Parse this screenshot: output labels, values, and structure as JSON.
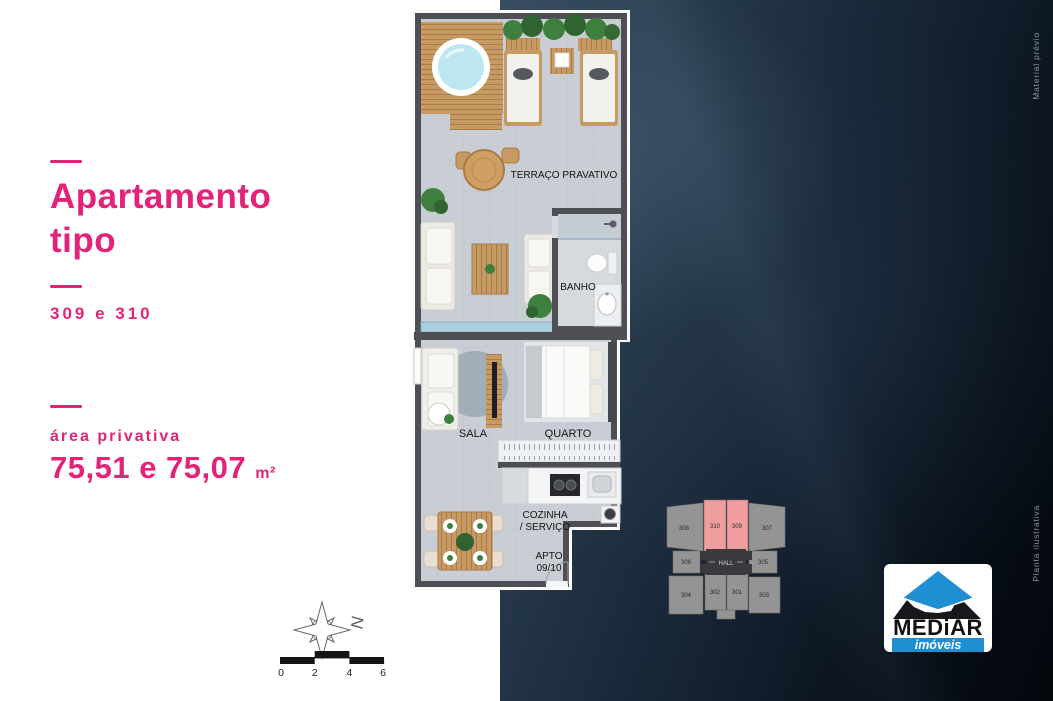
{
  "colors": {
    "accent": "#e32278",
    "dark_panel": "#0a1420",
    "keyplan_highlight": "#ef9e9d",
    "keyplan_gray": "#949494",
    "logo_blue": "#1e8fd2"
  },
  "info_panel": {
    "title_line1": "Apartamento",
    "title_line2": "tipo",
    "unit_numbers": "309 e 310",
    "area_label": "área privativa",
    "area_value": "75,51 e 75,07",
    "area_unit": "m²"
  },
  "floorplan": {
    "rooms": {
      "terrace": "TERRAÇO PRAVATIVO",
      "bathroom": "BANHO",
      "living": "SALA",
      "bedroom": "QUARTO",
      "kitchen_line1": "COZINHA",
      "kitchen_line2": "/ SERVIÇO",
      "unit_line1": "APTO",
      "unit_line2": "09/10"
    }
  },
  "keyplan": {
    "hall_label": "HALL",
    "units": [
      {
        "label": "308",
        "highlighted": false
      },
      {
        "label": "310",
        "highlighted": true
      },
      {
        "label": "309",
        "highlighted": true
      },
      {
        "label": "307",
        "highlighted": false
      },
      {
        "label": "306",
        "highlighted": false
      },
      {
        "label": "305",
        "highlighted": false
      },
      {
        "label": "304",
        "highlighted": false
      },
      {
        "label": "302",
        "highlighted": false
      },
      {
        "label": "301",
        "highlighted": false
      },
      {
        "label": "303",
        "highlighted": false
      }
    ]
  },
  "compass": {
    "north_label": "N"
  },
  "scale_bar": {
    "ticks": [
      "0",
      "2",
      "4",
      "6"
    ]
  },
  "logo": {
    "brand": "MEDiAR",
    "tagline": "imóveis"
  },
  "margin_notes": {
    "top_right": "Material prévio",
    "bottom_right": "Planta ilustrativa"
  }
}
